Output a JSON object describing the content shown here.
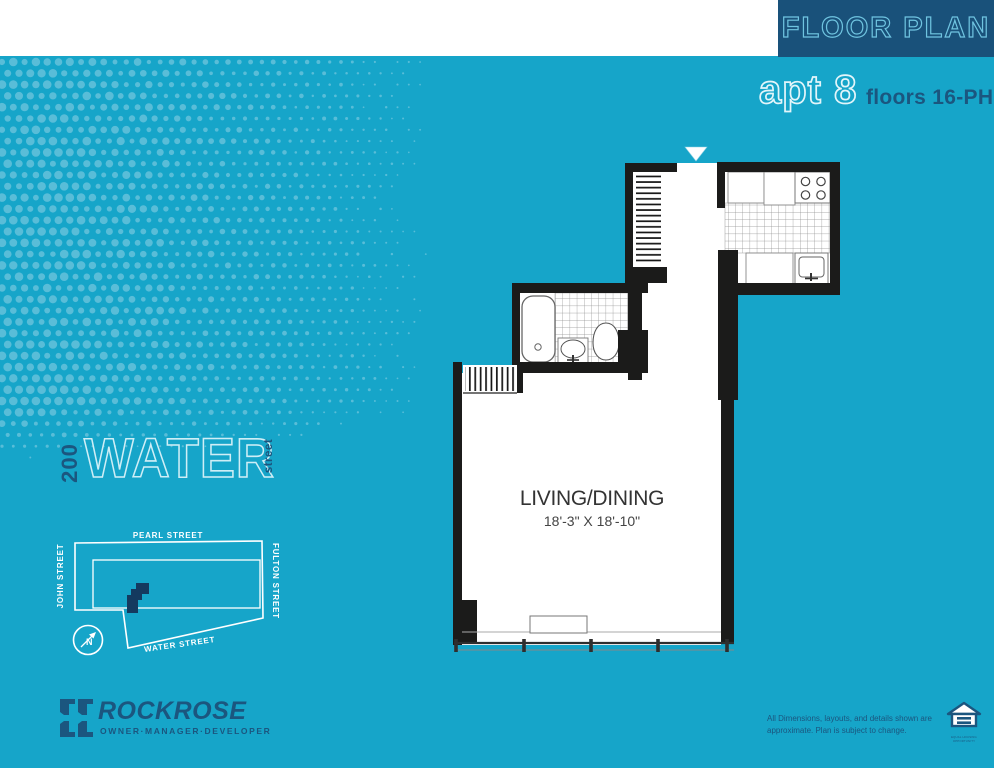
{
  "header": {
    "title": "FLOOR PLAN",
    "apt": "apt 8",
    "floors": "floors 16-PH"
  },
  "plan": {
    "room": "LIVING/DINING",
    "dimensions": "18'-3\" X 18'-10\""
  },
  "building_logo": {
    "number": "200",
    "name": "WATER",
    "suffix": "street"
  },
  "map": {
    "street_top": "PEARL STREET",
    "street_left": "JOHN STREET",
    "street_right": "FULTON STREET",
    "street_bottom": "WATER STREET",
    "compass": "N"
  },
  "developer": {
    "name": "ROCKROSE",
    "tagline": "OWNER·MANAGER·DEVELOPER"
  },
  "disclaimer": {
    "line1": "All Dimensions, layouts, and details shown are",
    "line2": "approximate. Plan is subject to change."
  },
  "eho": {
    "caption": "EQUAL HOUSING OPPORTUNITY"
  },
  "colors": {
    "background": "#16a5c9",
    "navy": "#1b567f",
    "header_box": "#19517a",
    "wall_black": "#1b1b1a",
    "halftone_dot": "#5fc0da",
    "outline_light": "#cfeef6",
    "footprint_navy": "#143a5f"
  }
}
